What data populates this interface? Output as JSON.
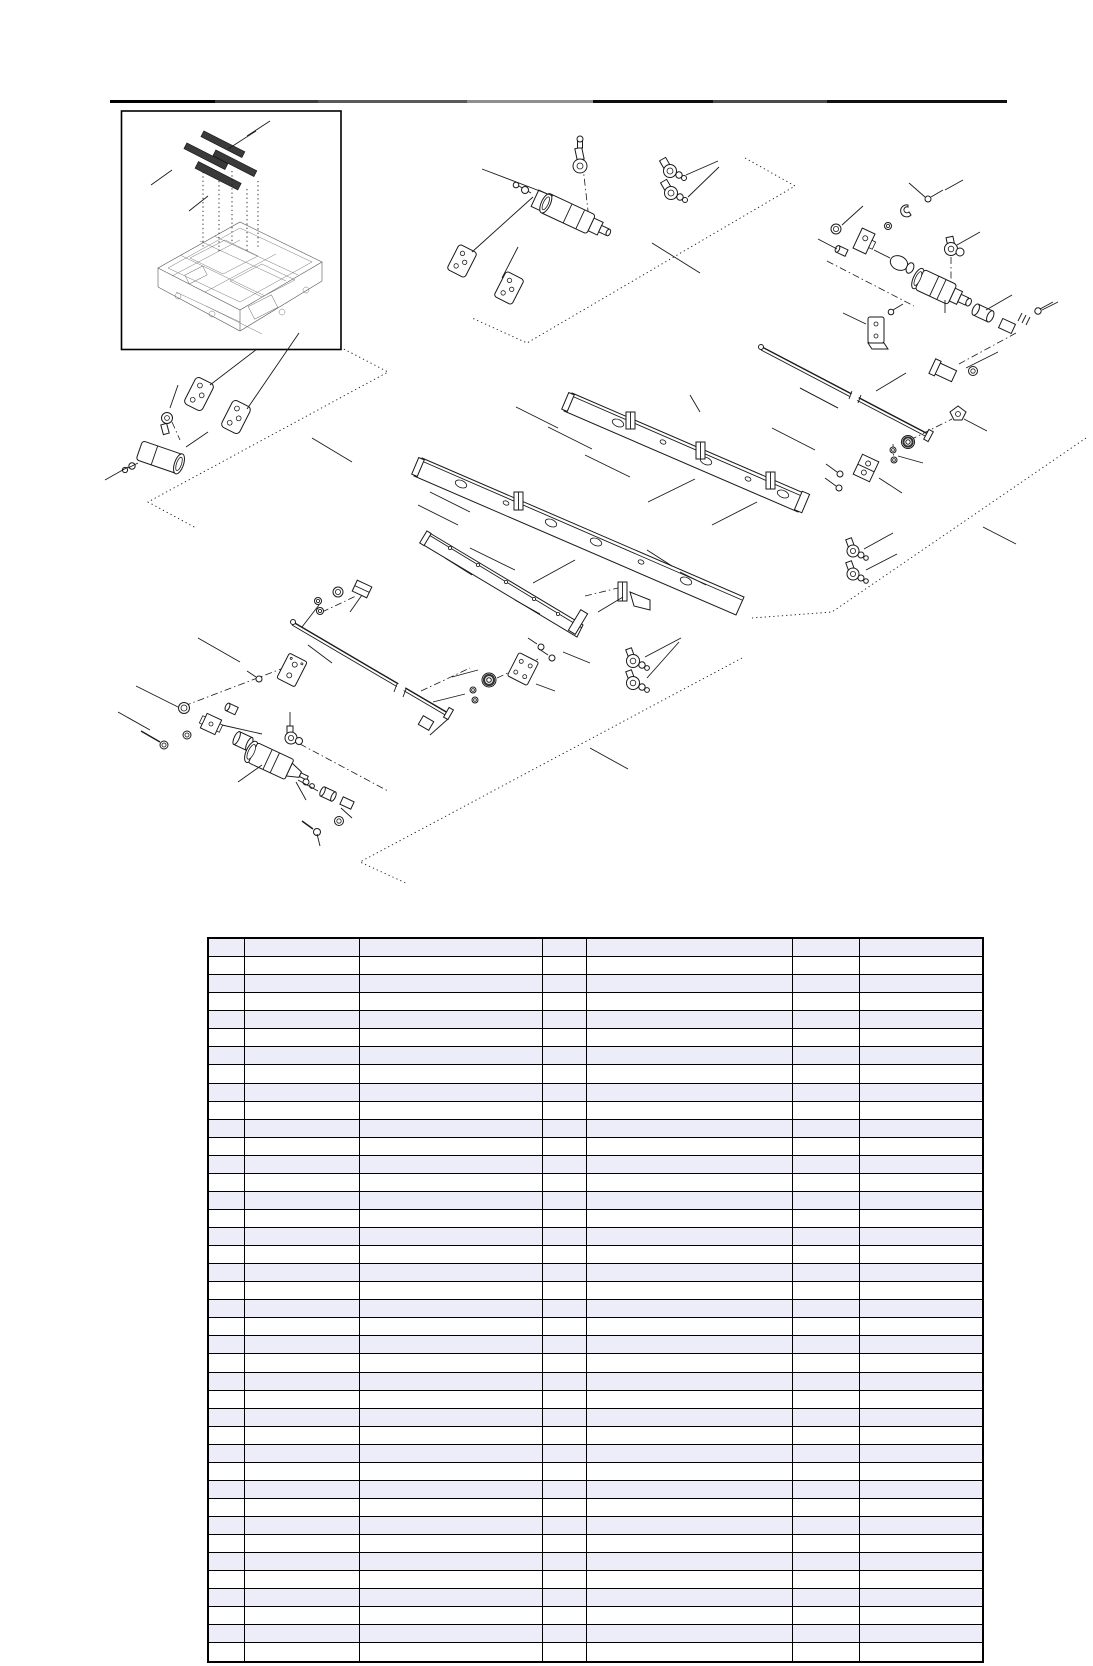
{
  "page": {
    "kind": "parts-catalog-page",
    "width_px": 1093,
    "height_px": 1666,
    "background": "#ffffff",
    "contains_text": false
  },
  "header_rule": {
    "y_px": 100,
    "segments": [
      {
        "x": 110,
        "w": 105,
        "color": "#000000"
      },
      {
        "x": 215,
        "w": 103,
        "color": "#3c3c3c"
      },
      {
        "x": 318,
        "w": 149,
        "color": "#5a5a5a"
      },
      {
        "x": 467,
        "w": 126,
        "color": "#8f8f8f"
      },
      {
        "x": 593,
        "w": 120,
        "color": "#0d0d0d"
      },
      {
        "x": 713,
        "w": 114,
        "color": "#4a4a4a"
      },
      {
        "x": 827,
        "w": 180,
        "color": "#111111"
      }
    ]
  },
  "inset_overview": {
    "border_color": "#000000",
    "blade_fill": "#0a0a0a",
    "frame_line_color": "#555555",
    "blade_count": 4,
    "drop_line_style": "dotted"
  },
  "exploded_diagram": {
    "line_color": "#1a1a1a",
    "part_fill": "#ffffff",
    "centerline_style": "dash-dot",
    "region_boundary_style": "dotted",
    "region_count": 4,
    "callout_numbers_visible": false,
    "part_kinds": [
      "pneumatic-cylinder",
      "elbow-fitting",
      "bracket-plate",
      "rail-with-holes",
      "rod",
      "washer",
      "nut",
      "screw",
      "pulley",
      "sleeve",
      "valve-block"
    ]
  },
  "parts_table": {
    "row_count": 40,
    "column_count": 7,
    "column_widths_px": [
      36,
      115,
      183,
      44,
      206,
      67,
      124
    ],
    "left_px": 207,
    "top_px": 937,
    "height_px": 726,
    "header_fill": "#EDEDF9",
    "alt_row_fill": "#EDEDF9",
    "row_fill": "#FFFFFF",
    "border_color": "#000000",
    "all_cells_empty": true,
    "cell_text": ""
  }
}
